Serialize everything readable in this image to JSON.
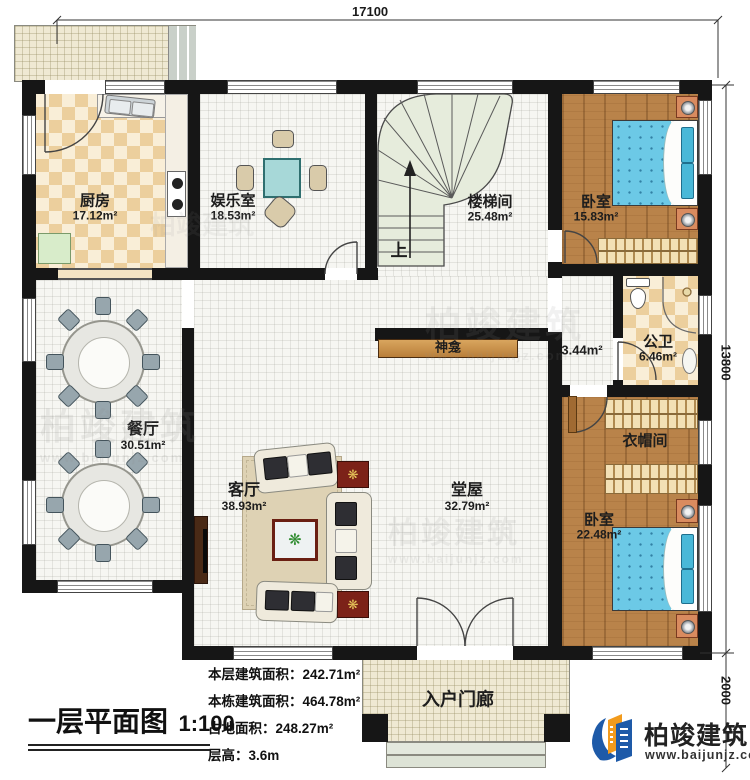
{
  "title": {
    "text": "一层平面图",
    "scale": "1:100"
  },
  "dimensions": {
    "width_total": "17100",
    "height_total": "13800",
    "porch_depth": "2000"
  },
  "rooms": {
    "kitchen": {
      "name": "厨房",
      "area": "17.12m²"
    },
    "entertainment": {
      "name": "娱乐室",
      "area": "18.53m²"
    },
    "stairwell": {
      "name": "楼梯间",
      "area": "25.48m²",
      "up_label": "上"
    },
    "bedroom1": {
      "name": "卧室",
      "area": "15.83m²"
    },
    "bathroom": {
      "name": "公卫",
      "area": "6.46m²"
    },
    "hallway": {
      "area": "3.44m²"
    },
    "cloakroom": {
      "name": "衣帽间"
    },
    "bedroom2": {
      "name": "卧室",
      "area": "22.48m²"
    },
    "dining": {
      "name": "餐厅",
      "area": "30.51m²"
    },
    "living": {
      "name": "客厅",
      "area": "38.93m²"
    },
    "hall": {
      "name": "堂屋",
      "area": "32.79m²"
    },
    "shrine": {
      "name": "神龛"
    },
    "porch": {
      "name": "入户门廊"
    }
  },
  "info": {
    "lines": [
      {
        "label": "本层建筑面积：",
        "value": "242.71m²"
      },
      {
        "label": "本栋建筑面积：",
        "value": "464.78m²"
      },
      {
        "label": "占地面积：",
        "value": "248.27m²"
      },
      {
        "label": "层高：",
        "value": "3.6m"
      }
    ]
  },
  "logo": {
    "name": "柏竣建筑",
    "url": "www.baijunjz.com"
  },
  "colors": {
    "wall": "#161616",
    "wood_floor": "#b9834a",
    "bed_blue": "#6cc9e6",
    "checker_tile": "#eccf9d",
    "logo_blue": "#1e5aa8",
    "logo_orange": "#f29b1d"
  }
}
